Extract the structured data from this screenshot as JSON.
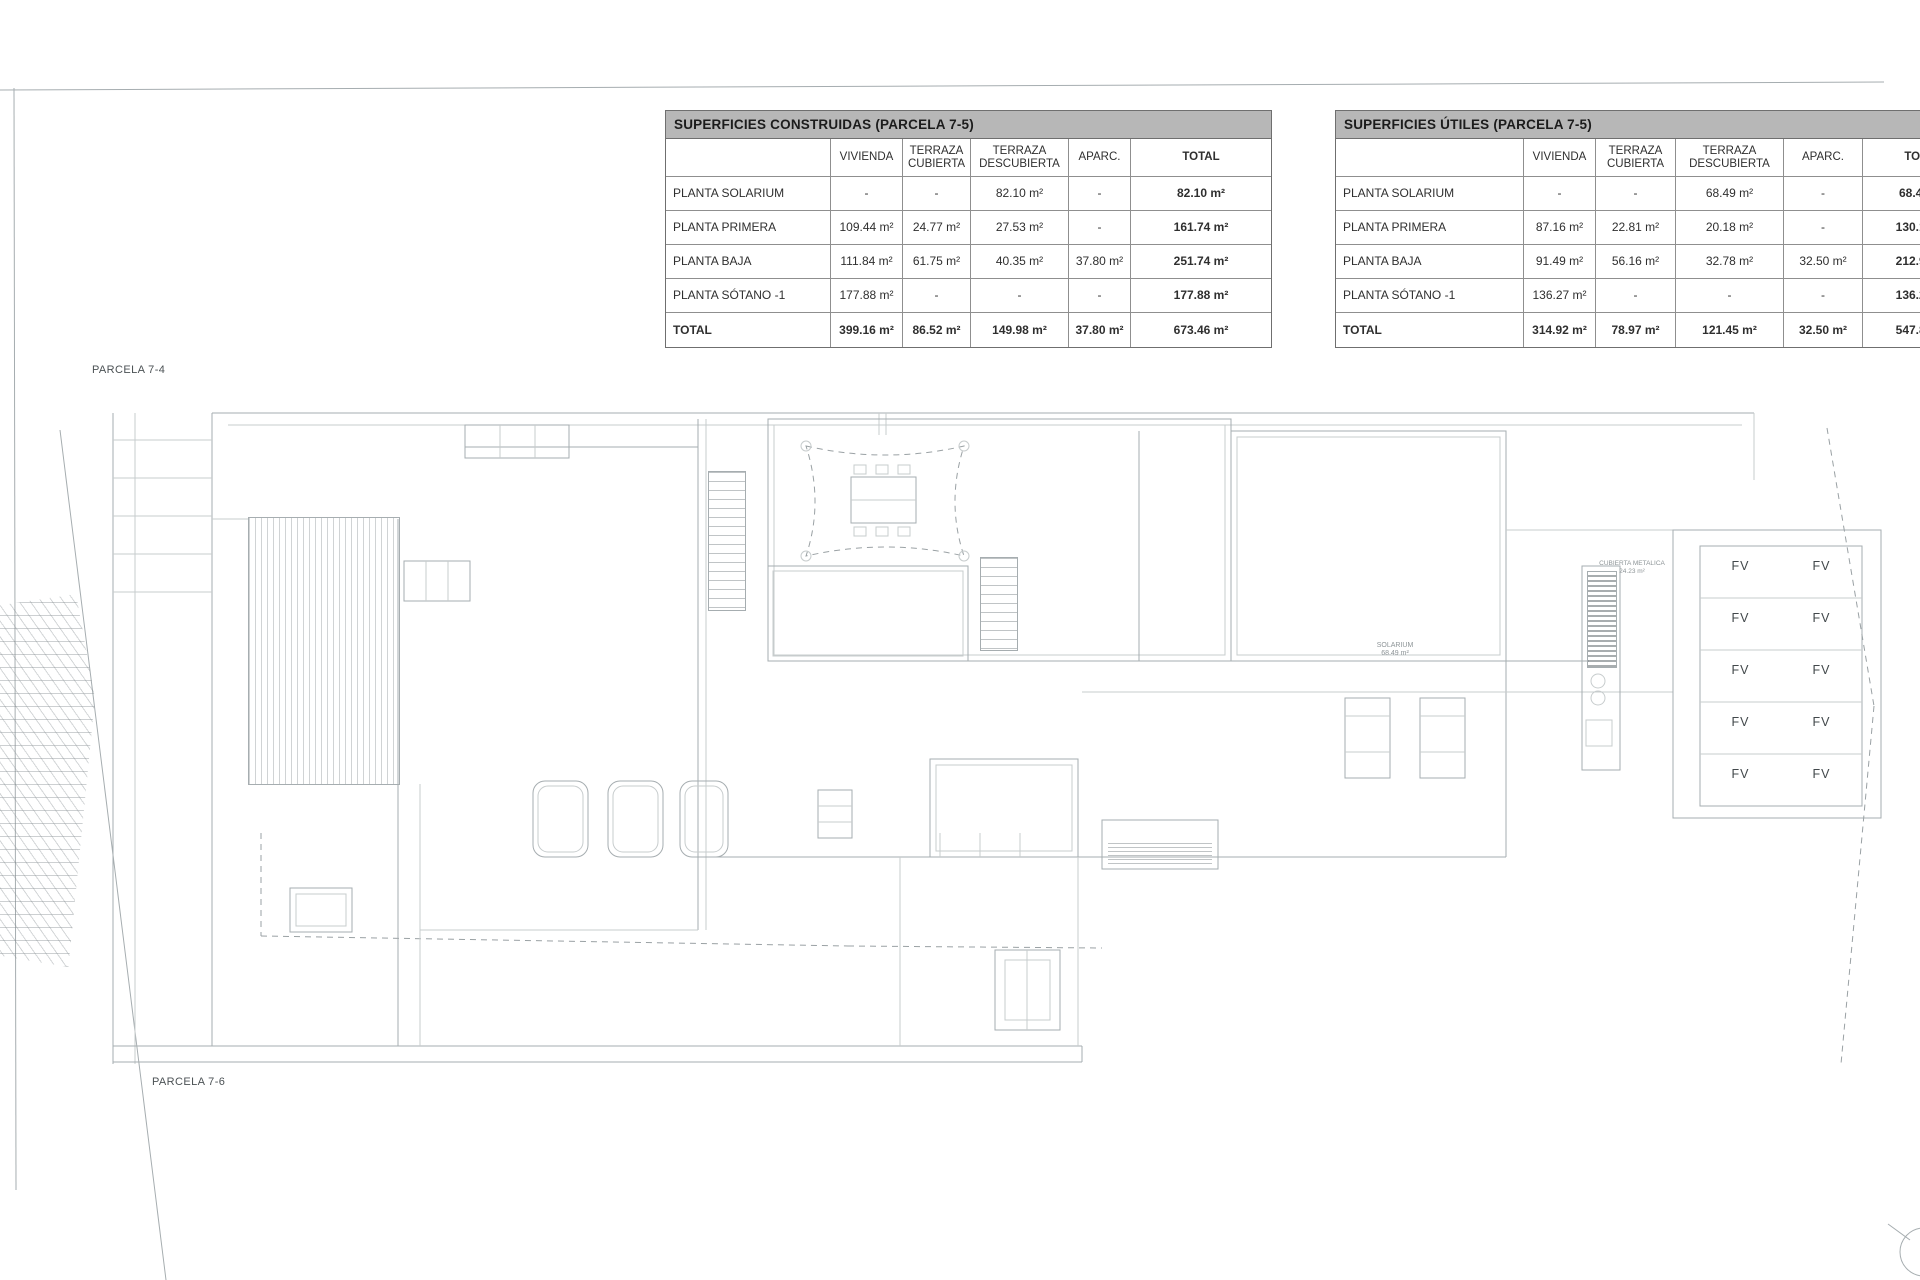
{
  "plan": {
    "parcela_top_label": "PARCELA 7-4",
    "parcela_bottom_label": "PARCELA 7-6",
    "fv_label": "FV",
    "fv_panel_count": 10,
    "solarium_note": [
      "SOLARIUM",
      "68.49 m²"
    ],
    "cubierta_note": [
      "CUBIERTA METALICA",
      "24.23 m²"
    ]
  },
  "tables": [
    {
      "title": "SUPERFICIES CONSTRUIDAS (PARCELA 7-5)",
      "columns": [
        "",
        "VIVIENDA",
        "TERRAZA CUBIERTA",
        "TERRAZA DESCUBIERTA",
        "APARC.",
        "TOTAL"
      ],
      "rows": [
        {
          "label": "PLANTA SOLARIUM",
          "values": [
            "-",
            "-",
            "82.10 m²",
            "-",
            "82.10 m²"
          ],
          "total": false
        },
        {
          "label": "PLANTA PRIMERA",
          "values": [
            "109.44 m²",
            "24.77 m²",
            "27.53 m²",
            "-",
            "161.74 m²"
          ],
          "total": false
        },
        {
          "label": "PLANTA BAJA",
          "values": [
            "111.84 m²",
            "61.75 m²",
            "40.35 m²",
            "37.80 m²",
            "251.74 m²"
          ],
          "total": false
        },
        {
          "label": "PLANTA SÓTANO -1",
          "values": [
            "177.88 m²",
            "-",
            "-",
            "-",
            "177.88 m²"
          ],
          "total": false
        },
        {
          "label": "TOTAL",
          "values": [
            "399.16 m²",
            "86.52 m²",
            "149.98 m²",
            "37.80 m²",
            "673.46 m²"
          ],
          "total": true
        }
      ]
    },
    {
      "title": "SUPERFICIES ÚTILES (PARCELA 7-5)",
      "columns": [
        "",
        "VIVIENDA",
        "TERRAZA CUBIERTA",
        "TERRAZA DESCUBIERTA",
        "APARC.",
        "TOTAL"
      ],
      "rows": [
        {
          "label": "PLANTA SOLARIUM",
          "values": [
            "-",
            "-",
            "68.49 m²",
            "-",
            "68.49 m²"
          ],
          "total": false
        },
        {
          "label": "PLANTA PRIMERA",
          "values": [
            "87.16 m²",
            "22.81 m²",
            "20.18 m²",
            "-",
            "130.15 m²"
          ],
          "total": false
        },
        {
          "label": "PLANTA BAJA",
          "values": [
            "91.49 m²",
            "56.16 m²",
            "32.78 m²",
            "32.50 m²",
            "212.93 m²"
          ],
          "total": false
        },
        {
          "label": "PLANTA SÓTANO -1",
          "values": [
            "136.27 m²",
            "-",
            "-",
            "-",
            "136.27 m²"
          ],
          "total": false
        },
        {
          "label": "TOTAL",
          "values": [
            "314.92 m²",
            "78.97 m²",
            "121.45 m²",
            "32.50 m²",
            "547.84 m²"
          ],
          "total": true
        }
      ]
    }
  ],
  "colors": {
    "table_header_bg": "#b7b7b7",
    "table_border": "#6f6f6f",
    "plan_line": "#a6adb0",
    "text": "#2f2f2f"
  }
}
